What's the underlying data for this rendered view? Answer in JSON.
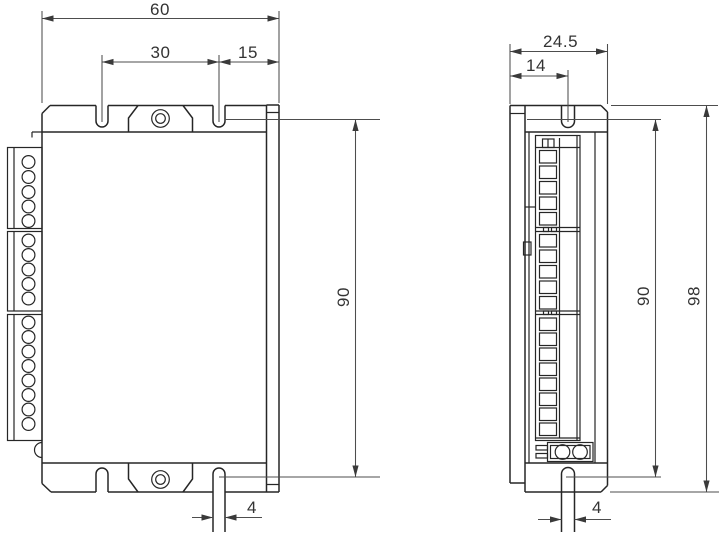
{
  "drawing": {
    "type": "technical-dimension-drawing",
    "background": "#ffffff",
    "line_color": "#262626",
    "dimension_color": "#4d4d4d",
    "views": {
      "front": {
        "dims": {
          "width": "60",
          "slot_spacing": "30",
          "slot_edge_offset": "15",
          "mount_height": "90",
          "slot_width": "4"
        },
        "connector_blocks": [
          {
            "terminals": 5
          },
          {
            "terminals": 5
          },
          {
            "terminals": 8
          }
        ],
        "mounting_slots": 4,
        "screw_holes": 2
      },
      "side": {
        "dims": {
          "depth": "24.5",
          "slot_center_offset": "14",
          "mount_height": "90",
          "overall_height": "98",
          "slot_width": "4"
        },
        "terminal_stacks": 3,
        "bottom_connector_holes": 2
      }
    }
  }
}
